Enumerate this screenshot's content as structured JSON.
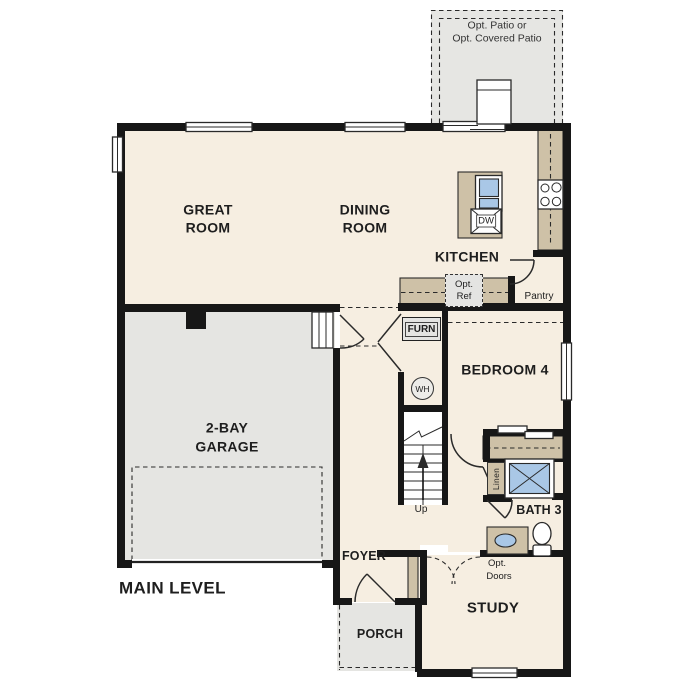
{
  "plan": {
    "title": "MAIN LEVEL",
    "patio": {
      "line1": "Opt. Patio or",
      "line2": "Opt. Covered Patio"
    },
    "great_room": {
      "line1": "GREAT",
      "line2": "ROOM"
    },
    "dining_room": {
      "line1": "DINING",
      "line2": "ROOM"
    },
    "kitchen": {
      "label": "KITCHEN"
    },
    "pantry": {
      "label": "Pantry"
    },
    "opt_ref": {
      "line1": "Opt.",
      "line2": "Ref"
    },
    "furnace": {
      "label": "FURN"
    },
    "water_heater": {
      "label": "WH"
    },
    "dishwasher": {
      "label": "DW"
    },
    "garage": {
      "line1": "2-BAY",
      "line2": "GARAGE"
    },
    "bedroom4": {
      "label": "BEDROOM 4"
    },
    "linen": {
      "label": "Linen"
    },
    "bath3": {
      "label": "BATH 3"
    },
    "stairs": {
      "label": "Up"
    },
    "foyer": {
      "label": "FOYER"
    },
    "porch": {
      "label": "PORCH"
    },
    "study": {
      "label": "STUDY"
    },
    "opt_doors": {
      "line1": "Opt.",
      "line2": "Doors"
    }
  },
  "colors": {
    "floor": "#f6eee1",
    "garage_floor": "#e5e5e2",
    "patio_floor": "#e6e6e3",
    "counter": "#cec1a7",
    "fixture_blue": "#a9c7e6",
    "appliance_gray": "#e4e4e2",
    "wall": "#171717",
    "text": "#1e1e1e",
    "line": "#2a2a2a"
  }
}
